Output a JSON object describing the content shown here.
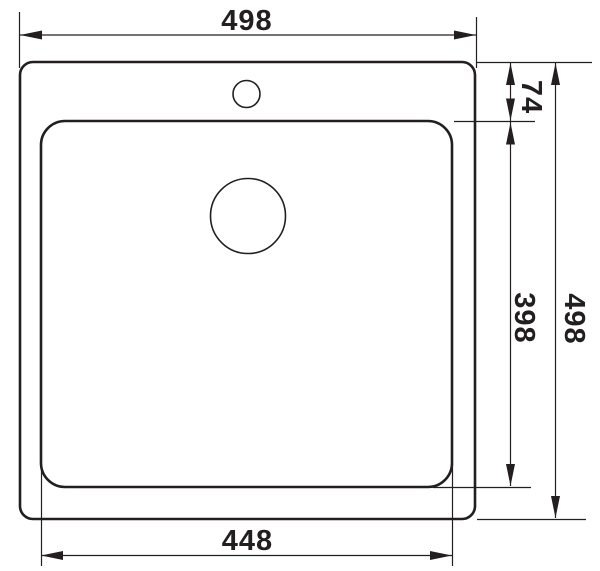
{
  "diagram": {
    "kind": "technical-drawing-top-view",
    "dimensions": {
      "overall_width": "498",
      "rim_to_basin_top": "74",
      "basin_depth": "398",
      "overall_depth": "498",
      "basin_width": "448"
    }
  },
  "colors": {
    "line": "#231f20",
    "background": "#ffffff"
  }
}
